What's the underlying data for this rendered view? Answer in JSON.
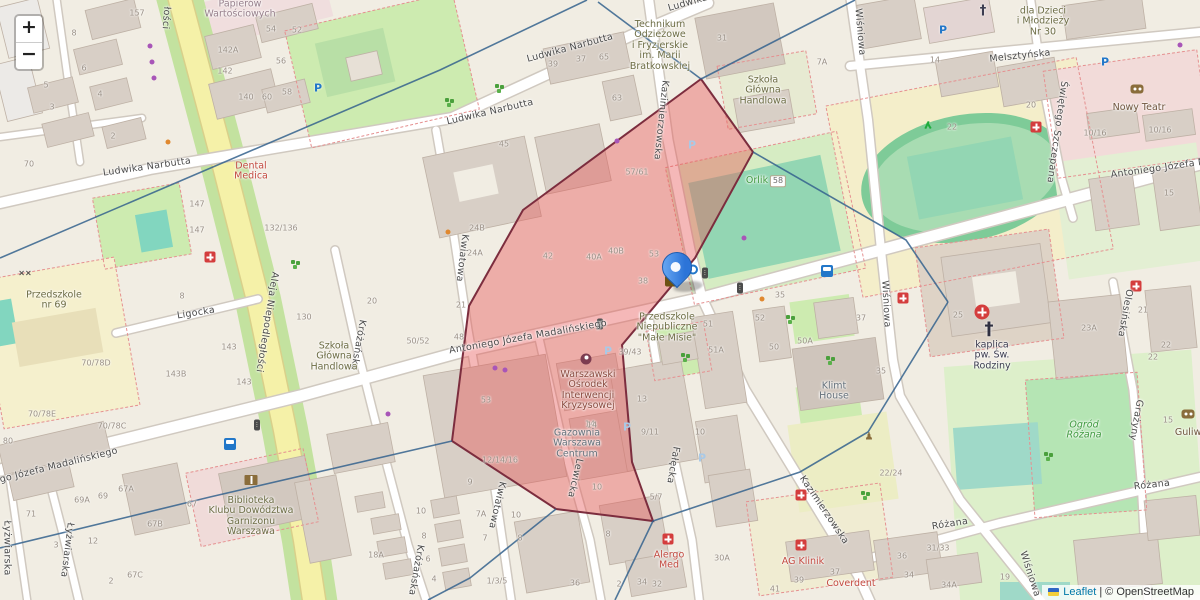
{
  "controls": {
    "zoom_in": "+",
    "zoom_out": "−"
  },
  "attribution": {
    "leaflet": "Leaflet",
    "separator": "|",
    "copyright": "© OpenStreetMap"
  },
  "marker": {
    "x": 676,
    "y": 291
  },
  "overlay": {
    "red_fill": "#e85555",
    "red_stroke": "#7c2d3e",
    "line_color": "#34618d",
    "red_polygon": [
      [
        701,
        79
      ],
      [
        753,
        152
      ],
      [
        695,
        258
      ],
      [
        622,
        345
      ],
      [
        632,
        462
      ],
      [
        653,
        521
      ],
      [
        556,
        509
      ],
      [
        452,
        441
      ],
      [
        469,
        306
      ],
      [
        523,
        210
      ]
    ],
    "boundary_lines": [
      [
        [
          587,
          0
        ],
        [
          440,
          70
        ],
        [
          0,
          258
        ]
      ],
      [
        [
          598,
          2
        ],
        [
          701,
          79
        ]
      ],
      [
        [
          701,
          79
        ],
        [
          855,
          0
        ]
      ],
      [
        [
          753,
          152
        ],
        [
          906,
          240
        ],
        [
          948,
          302
        ]
      ],
      [
        [
          948,
          302
        ],
        [
          868,
          432
        ],
        [
          800,
          472
        ],
        [
          653,
          521
        ]
      ],
      [
        [
          653,
          521
        ],
        [
          615,
          600
        ]
      ],
      [
        [
          452,
          441
        ],
        [
          210,
          497
        ],
        [
          0,
          548
        ]
      ],
      [
        [
          556,
          509
        ],
        [
          470,
          578
        ],
        [
          428,
          600
        ]
      ]
    ]
  },
  "streets": [
    {
      "t": "Ludwika Narbutta",
      "x": 570,
      "y": 48,
      "r": -15
    },
    {
      "t": "Ludwika Narbutta",
      "x": 490,
      "y": 112,
      "r": -13
    },
    {
      "t": "Ludwika Narbutta",
      "x": 147,
      "y": 167,
      "r": -8
    },
    {
      "t": "Ludwika",
      "x": 688,
      "y": 3,
      "r": -16
    },
    {
      "t": "Aleja Niepodległości",
      "x": 267,
      "y": 322,
      "r": 99
    },
    {
      "t": "łości",
      "x": 166,
      "y": 18,
      "r": 94
    },
    {
      "t": "Ligocka",
      "x": 196,
      "y": 313,
      "r": -9
    },
    {
      "t": "Antoniego Józefa Madalińskiego",
      "x": 528,
      "y": 337,
      "r": -10
    },
    {
      "t": "Antoniego Józefa Madalińskiego",
      "x": 40,
      "y": 470,
      "r": -14
    },
    {
      "t": "Antoniego Józefa Madalińskiego",
      "x": 1190,
      "y": 164,
      "r": -8
    },
    {
      "t": "Kazimierzowska",
      "x": 661,
      "y": 120,
      "r": 96
    },
    {
      "t": "Kazimierzowska",
      "x": 824,
      "y": 510,
      "r": 56
    },
    {
      "t": "Wiśniowa",
      "x": 860,
      "y": 32,
      "r": 85
    },
    {
      "t": "Wiśniowa",
      "x": 886,
      "y": 304,
      "r": 87
    },
    {
      "t": "Wiśniowa",
      "x": 1030,
      "y": 574,
      "r": 72
    },
    {
      "t": "Melsztyńska",
      "x": 1020,
      "y": 56,
      "r": -6
    },
    {
      "t": "Świętego Szczepana",
      "x": 1057,
      "y": 132,
      "r": 98
    },
    {
      "t": "Kwiatowa",
      "x": 462,
      "y": 258,
      "r": 97
    },
    {
      "t": "Kwiatowa",
      "x": 497,
      "y": 505,
      "r": 103
    },
    {
      "t": "Króżańska",
      "x": 358,
      "y": 345,
      "r": 100
    },
    {
      "t": "Króżańska",
      "x": 416,
      "y": 570,
      "r": 100
    },
    {
      "t": "Lewicka",
      "x": 575,
      "y": 478,
      "r": 103
    },
    {
      "t": "Fałęcka",
      "x": 673,
      "y": 465,
      "r": 100
    },
    {
      "t": "Łyżwiarska",
      "x": 67,
      "y": 550,
      "r": 97
    },
    {
      "t": "Łyżwiarska",
      "x": 7,
      "y": 548,
      "r": 90
    },
    {
      "t": "Różana",
      "x": 950,
      "y": 524,
      "r": -9
    },
    {
      "t": "Różana",
      "x": 1152,
      "y": 485,
      "r": -6
    },
    {
      "t": "Olesińska",
      "x": 1125,
      "y": 313,
      "r": 100
    },
    {
      "t": "Grażyny",
      "x": 1136,
      "y": 420,
      "r": 100
    }
  ],
  "pois": [
    {
      "id": "papierow",
      "cls": "muted",
      "x": 240,
      "y": 10,
      "lines": [
        "Papierów",
        "Wartościowych"
      ]
    },
    {
      "id": "technikum",
      "cls": "school",
      "x": 660,
      "y": 46,
      "lines": [
        "Technikum",
        "Odzieżowe",
        "i Fryzjerskie",
        "im. Marii",
        "Bratkowskiej"
      ]
    },
    {
      "id": "sgh-north",
      "cls": "school",
      "x": 763,
      "y": 91,
      "lines": [
        "Szkoła",
        "Główna",
        "Handlowa"
      ]
    },
    {
      "id": "sgh-west",
      "cls": "school",
      "x": 334,
      "y": 357,
      "lines": [
        "Szkoła",
        "Główna",
        "Handlowa"
      ]
    },
    {
      "id": "dental-medica",
      "cls": "med",
      "x": 251,
      "y": 172,
      "lines": [
        "Dental",
        "Medica"
      ]
    },
    {
      "id": "przedszkole-69",
      "cls": "school",
      "x": 54,
      "y": 301,
      "lines": [
        "Przedszkole",
        "nr 69"
      ]
    },
    {
      "id": "male-misie",
      "cls": "school",
      "x": 667,
      "y": 328,
      "lines": [
        "Przedszkole",
        "Niepubliczne",
        "\"Małe Misie\""
      ]
    },
    {
      "id": "woik",
      "cls": "social-t",
      "x": 588,
      "y": 391,
      "lines": [
        "Warszawski",
        "Ośrodek",
        "Interwencji",
        "Kryzysowej"
      ]
    },
    {
      "id": "gazownia",
      "cls": "ind",
      "x": 577,
      "y": 444,
      "lines": [
        "Gazownia",
        "Warszawa",
        "Centrum"
      ]
    },
    {
      "id": "biblioteka",
      "cls": "school",
      "x": 251,
      "y": 517,
      "lines": [
        "Biblioteka",
        "Klubu Dowództwa",
        "Garnizonu",
        "Warszawa"
      ]
    },
    {
      "id": "klimt-house",
      "cls": "ind",
      "x": 834,
      "y": 392,
      "lines": [
        "Klimt",
        "House"
      ]
    },
    {
      "id": "kaplica",
      "cls": "church-t",
      "x": 992,
      "y": 356,
      "lines": [
        "kaplica",
        "pw. Św.",
        "Rodziny"
      ]
    },
    {
      "id": "ogrod-rozana",
      "cls": "park-t",
      "x": 1084,
      "y": 431,
      "lines": [
        "Ogród",
        "Różana"
      ]
    },
    {
      "id": "orlik",
      "cls": "leisure",
      "x": 757,
      "y": 181,
      "lines": [
        "Orlik"
      ]
    },
    {
      "id": "alergo-med",
      "cls": "med",
      "x": 669,
      "y": 561,
      "lines": [
        "Alergo",
        "Med"
      ]
    },
    {
      "id": "ag-klinik",
      "cls": "med",
      "x": 803,
      "y": 562,
      "lines": [
        "AG Klinik"
      ]
    },
    {
      "id": "coverdent",
      "cls": "med",
      "x": 851,
      "y": 584,
      "lines": [
        "Coverdent"
      ]
    },
    {
      "id": "nowy-teatr",
      "cls": "theatre",
      "x": 1139,
      "y": 108,
      "lines": [
        "Nowy Teatr"
      ]
    },
    {
      "id": "guliwer",
      "cls": "theatre",
      "x": 1193,
      "y": 433,
      "lines": [
        "Guliwer"
      ]
    },
    {
      "id": "dzieci-mlodziezy",
      "cls": "school",
      "x": 1043,
      "y": 22,
      "lines": [
        "dla Dzieci",
        "i Młodzieży",
        "Nr 30"
      ]
    }
  ],
  "badges": [
    {
      "t": "58",
      "x": 778,
      "y": 181
    }
  ],
  "house_numbers": [
    {
      "t": "157",
      "x": 137,
      "y": 13
    },
    {
      "t": "8",
      "x": 74,
      "y": 33
    },
    {
      "t": "6",
      "x": 84,
      "y": 68
    },
    {
      "t": "5",
      "x": 46,
      "y": 85
    },
    {
      "t": "4",
      "x": 100,
      "y": 94
    },
    {
      "t": "3",
      "x": 52,
      "y": 107
    },
    {
      "t": "2",
      "x": 113,
      "y": 136
    },
    {
      "t": "142A",
      "x": 228,
      "y": 50
    },
    {
      "t": "142",
      "x": 225,
      "y": 71
    },
    {
      "t": "140",
      "x": 246,
      "y": 97
    },
    {
      "t": "60",
      "x": 267,
      "y": 97
    },
    {
      "t": "58",
      "x": 287,
      "y": 92
    },
    {
      "t": "54",
      "x": 271,
      "y": 29
    },
    {
      "t": "52",
      "x": 297,
      "y": 30
    },
    {
      "t": "56",
      "x": 281,
      "y": 61
    },
    {
      "t": "70",
      "x": 29,
      "y": 164
    },
    {
      "t": "147",
      "x": 197,
      "y": 204
    },
    {
      "t": "147",
      "x": 197,
      "y": 230
    },
    {
      "t": "132/136",
      "x": 281,
      "y": 228
    },
    {
      "t": "8",
      "x": 182,
      "y": 296
    },
    {
      "t": "143",
      "x": 229,
      "y": 347
    },
    {
      "t": "143B",
      "x": 176,
      "y": 374
    },
    {
      "t": "143",
      "x": 244,
      "y": 382
    },
    {
      "t": "70/78D",
      "x": 96,
      "y": 363
    },
    {
      "t": "70/78E",
      "x": 42,
      "y": 414
    },
    {
      "t": "70/78C",
      "x": 112,
      "y": 426
    },
    {
      "t": "80",
      "x": 8,
      "y": 441
    },
    {
      "t": "71",
      "x": 31,
      "y": 514
    },
    {
      "t": "69A",
      "x": 82,
      "y": 500
    },
    {
      "t": "69",
      "x": 103,
      "y": 496
    },
    {
      "t": "67A",
      "x": 126,
      "y": 489
    },
    {
      "t": "67",
      "x": 192,
      "y": 504
    },
    {
      "t": "67B",
      "x": 155,
      "y": 524
    },
    {
      "t": "12",
      "x": 93,
      "y": 541
    },
    {
      "t": "3",
      "x": 56,
      "y": 545
    },
    {
      "t": "2",
      "x": 111,
      "y": 581
    },
    {
      "t": "67C",
      "x": 135,
      "y": 575
    },
    {
      "t": "39",
      "x": 553,
      "y": 64
    },
    {
      "t": "37",
      "x": 581,
      "y": 59
    },
    {
      "t": "65",
      "x": 604,
      "y": 57
    },
    {
      "t": "63",
      "x": 617,
      "y": 98
    },
    {
      "t": "45",
      "x": 504,
      "y": 144
    },
    {
      "t": "31",
      "x": 722,
      "y": 38
    },
    {
      "t": "7A",
      "x": 822,
      "y": 62
    },
    {
      "t": "57/61",
      "x": 637,
      "y": 172
    },
    {
      "t": "42",
      "x": 548,
      "y": 256
    },
    {
      "t": "40A",
      "x": 594,
      "y": 257
    },
    {
      "t": "40B",
      "x": 616,
      "y": 251
    },
    {
      "t": "53",
      "x": 654,
      "y": 254
    },
    {
      "t": "38",
      "x": 643,
      "y": 281
    },
    {
      "t": "24B",
      "x": 477,
      "y": 228
    },
    {
      "t": "24A",
      "x": 475,
      "y": 253
    },
    {
      "t": "130",
      "x": 304,
      "y": 317
    },
    {
      "t": "20",
      "x": 372,
      "y": 301
    },
    {
      "t": "21",
      "x": 461,
      "y": 305
    },
    {
      "t": "50/52",
      "x": 418,
      "y": 341
    },
    {
      "t": "48",
      "x": 459,
      "y": 337
    },
    {
      "t": "53",
      "x": 486,
      "y": 400
    },
    {
      "t": "14",
      "x": 590,
      "y": 424
    },
    {
      "t": "13",
      "x": 642,
      "y": 399
    },
    {
      "t": "39/43",
      "x": 630,
      "y": 352
    },
    {
      "t": "9/11",
      "x": 650,
      "y": 432
    },
    {
      "t": "10",
      "x": 700,
      "y": 432
    },
    {
      "t": "51",
      "x": 708,
      "y": 324
    },
    {
      "t": "51A",
      "x": 716,
      "y": 350
    },
    {
      "t": "52",
      "x": 760,
      "y": 318
    },
    {
      "t": "35",
      "x": 780,
      "y": 295
    },
    {
      "t": "50A",
      "x": 805,
      "y": 341
    },
    {
      "t": "50",
      "x": 774,
      "y": 347
    },
    {
      "t": "35",
      "x": 881,
      "y": 371
    },
    {
      "t": "37",
      "x": 861,
      "y": 318
    },
    {
      "t": "25",
      "x": 958,
      "y": 315
    },
    {
      "t": "23A",
      "x": 1089,
      "y": 328
    },
    {
      "t": "21",
      "x": 1143,
      "y": 310
    },
    {
      "t": "22",
      "x": 1166,
      "y": 345
    },
    {
      "t": "22",
      "x": 1153,
      "y": 357
    },
    {
      "t": "15",
      "x": 1168,
      "y": 420
    },
    {
      "t": "22/24",
      "x": 891,
      "y": 473
    },
    {
      "t": "5/7",
      "x": 656,
      "y": 497
    },
    {
      "t": "12/14/16",
      "x": 500,
      "y": 460
    },
    {
      "t": "9",
      "x": 470,
      "y": 482
    },
    {
      "t": "7A",
      "x": 481,
      "y": 514
    },
    {
      "t": "10",
      "x": 516,
      "y": 515
    },
    {
      "t": "7",
      "x": 485,
      "y": 538
    },
    {
      "t": "8",
      "x": 520,
      "y": 538
    },
    {
      "t": "1/3/5",
      "x": 497,
      "y": 581
    },
    {
      "t": "36",
      "x": 575,
      "y": 583
    },
    {
      "t": "10",
      "x": 597,
      "y": 487
    },
    {
      "t": "14",
      "x": 592,
      "y": 425
    },
    {
      "t": "8",
      "x": 608,
      "y": 534
    },
    {
      "t": "2",
      "x": 619,
      "y": 584
    },
    {
      "t": "34",
      "x": 642,
      "y": 582
    },
    {
      "t": "32",
      "x": 657,
      "y": 584
    },
    {
      "t": "30A",
      "x": 722,
      "y": 558
    },
    {
      "t": "31/33",
      "x": 938,
      "y": 548
    },
    {
      "t": "36",
      "x": 902,
      "y": 556
    },
    {
      "t": "34",
      "x": 909,
      "y": 575
    },
    {
      "t": "34A",
      "x": 949,
      "y": 585
    },
    {
      "t": "37",
      "x": 835,
      "y": 572
    },
    {
      "t": "39",
      "x": 799,
      "y": 580
    },
    {
      "t": "41",
      "x": 775,
      "y": 589
    },
    {
      "t": "19",
      "x": 1005,
      "y": 577
    },
    {
      "t": "14",
      "x": 935,
      "y": 60
    },
    {
      "t": "20",
      "x": 1031,
      "y": 105
    },
    {
      "t": "22",
      "x": 952,
      "y": 127
    },
    {
      "t": "10/16",
      "x": 1095,
      "y": 133
    },
    {
      "t": "10/16",
      "x": 1160,
      "y": 130
    },
    {
      "t": "15",
      "x": 1169,
      "y": 193
    },
    {
      "t": "18A",
      "x": 376,
      "y": 555
    },
    {
      "t": "10",
      "x": 421,
      "y": 511
    },
    {
      "t": "8",
      "x": 424,
      "y": 536
    },
    {
      "t": "6",
      "x": 428,
      "y": 559
    },
    {
      "t": "4",
      "x": 434,
      "y": 579
    }
  ],
  "icon_glyphs": {
    "parking": "P",
    "parking-light": "P",
    "church-cross": "†",
    "church-cross-large": "†",
    "traffic-light": "⋮",
    "statue": "♟",
    "playground": "××"
  },
  "icons": [
    {
      "type": "post-office",
      "x": 672,
      "y": 281
    },
    {
      "type": "bike",
      "x": 690,
      "y": 268
    },
    {
      "type": "bus",
      "x": 827,
      "y": 271
    },
    {
      "type": "bus",
      "x": 230,
      "y": 444
    },
    {
      "type": "traffic-light",
      "x": 705,
      "y": 273
    },
    {
      "type": "traffic-light",
      "x": 740,
      "y": 288
    },
    {
      "type": "traffic-light",
      "x": 600,
      "y": 324
    },
    {
      "type": "traffic-light",
      "x": 257,
      "y": 425
    },
    {
      "type": "parking",
      "x": 318,
      "y": 88
    },
    {
      "type": "parking",
      "x": 943,
      "y": 30
    },
    {
      "type": "parking",
      "x": 1105,
      "y": 62
    },
    {
      "type": "parking-light",
      "x": 627,
      "y": 427
    },
    {
      "type": "parking-light",
      "x": 702,
      "y": 458
    },
    {
      "type": "parking-light",
      "x": 608,
      "y": 351
    },
    {
      "type": "parking-light",
      "x": 692,
      "y": 145
    },
    {
      "type": "medical",
      "x": 210,
      "y": 257
    },
    {
      "type": "medical",
      "x": 903,
      "y": 298
    },
    {
      "type": "medical",
      "x": 1136,
      "y": 286
    },
    {
      "type": "medical",
      "x": 1036,
      "y": 127
    },
    {
      "type": "medical",
      "x": 668,
      "y": 539
    },
    {
      "type": "medical",
      "x": 801,
      "y": 545
    },
    {
      "type": "medical",
      "x": 801,
      "y": 495
    },
    {
      "type": "medical-circle",
      "x": 982,
      "y": 312
    },
    {
      "type": "church-cross-large",
      "x": 989,
      "y": 329
    },
    {
      "type": "church-cross",
      "x": 983,
      "y": 11
    },
    {
      "type": "book",
      "x": 251,
      "y": 480
    },
    {
      "type": "social",
      "x": 586,
      "y": 359
    },
    {
      "type": "masks",
      "x": 1137,
      "y": 89
    },
    {
      "type": "masks",
      "x": 1188,
      "y": 414
    },
    {
      "type": "statue",
      "x": 869,
      "y": 437
    },
    {
      "type": "runner",
      "x": 928,
      "y": 125
    },
    {
      "type": "playground",
      "x": 25,
      "y": 273
    },
    {
      "type": "trees",
      "x": 497,
      "y": 86
    },
    {
      "type": "trees",
      "x": 447,
      "y": 100
    },
    {
      "type": "trees",
      "x": 788,
      "y": 317
    },
    {
      "type": "trees",
      "x": 863,
      "y": 493
    },
    {
      "type": "trees",
      "x": 683,
      "y": 355
    },
    {
      "type": "trees",
      "x": 828,
      "y": 358
    },
    {
      "type": "trees",
      "x": 293,
      "y": 262
    },
    {
      "type": "trees",
      "x": 1046,
      "y": 454
    },
    {
      "type": "dot-purple",
      "x": 150,
      "y": 46
    },
    {
      "type": "dot-purple",
      "x": 152,
      "y": 62
    },
    {
      "type": "dot-purple",
      "x": 154,
      "y": 78
    },
    {
      "type": "dot-purple",
      "x": 617,
      "y": 141
    },
    {
      "type": "dot-purple",
      "x": 495,
      "y": 368
    },
    {
      "type": "dot-purple",
      "x": 505,
      "y": 370
    },
    {
      "type": "dot-purple",
      "x": 388,
      "y": 414
    },
    {
      "type": "dot-purple",
      "x": 744,
      "y": 238
    },
    {
      "type": "dot-purple",
      "x": 1180,
      "y": 45
    },
    {
      "type": "dot-orange",
      "x": 762,
      "y": 299
    },
    {
      "type": "dot-orange",
      "x": 168,
      "y": 142
    },
    {
      "type": "dot-orange",
      "x": 448,
      "y": 232
    }
  ]
}
